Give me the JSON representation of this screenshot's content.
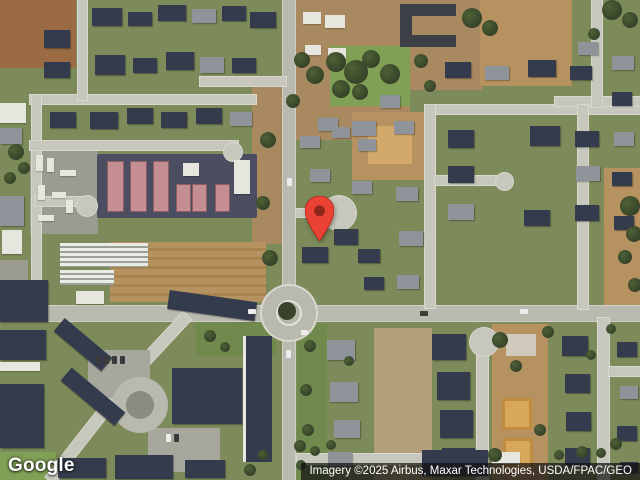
{
  "map": {
    "logo_text": "Google",
    "attribution_text": "Imagery ©2025 Airbus, Maxar Technologies, USDA/FPAC/GEO",
    "marker": {
      "fill": "#EA4335",
      "dot": "#8E2619",
      "tip_x": 319,
      "tip_y": 240
    },
    "features": [
      [
        "dirt2",
        0,
        0,
        76,
        68
      ],
      [
        "dirt3",
        252,
        82,
        34,
        162
      ],
      [
        "dirt3",
        295,
        0,
        115,
        140
      ],
      [
        "dirt3",
        396,
        0,
        86,
        90
      ],
      [
        "dirt",
        480,
        0,
        92,
        86
      ],
      [
        "dirt",
        352,
        112,
        80,
        68
      ],
      [
        "dirt4",
        368,
        126,
        44,
        38
      ],
      [
        "dirt",
        604,
        168,
        36,
        138
      ],
      [
        "field",
        110,
        242,
        156,
        60
      ],
      [
        "dirt5",
        374,
        328,
        58,
        152
      ],
      [
        "dirt",
        492,
        324,
        56,
        156
      ],
      [
        "lawn",
        330,
        46,
        80,
        60
      ],
      [
        "lawn",
        0,
        452,
        56,
        28
      ],
      [
        "lawn2",
        297,
        324,
        30,
        156
      ],
      [
        "lawn2",
        196,
        322,
        80,
        34
      ],
      [
        "yard",
        30,
        146,
        68,
        88
      ],
      [
        "yard",
        0,
        260,
        28,
        42
      ],
      [
        "asphL",
        97,
        154,
        160,
        64
      ],
      [
        "roadm",
        0,
        306,
        640,
        15
      ],
      [
        "roadm",
        283,
        0,
        12,
        480
      ],
      [
        "road",
        30,
        95,
        226,
        9
      ],
      [
        "road",
        78,
        0,
        9,
        100
      ],
      [
        "road",
        32,
        95,
        9,
        215
      ],
      [
        "road",
        30,
        141,
        208,
        9
      ],
      [
        "road",
        35,
        197,
        52,
        9
      ],
      [
        "cul",
        77,
        196,
        20,
        20
      ],
      [
        "cul",
        224,
        143,
        18,
        18
      ],
      [
        "road",
        200,
        77,
        86,
        9
      ],
      [
        "road",
        425,
        105,
        215,
        9
      ],
      [
        "road",
        425,
        105,
        10,
        203
      ],
      [
        "road",
        555,
        97,
        85,
        9
      ],
      [
        "road",
        592,
        0,
        10,
        107
      ],
      [
        "road",
        578,
        105,
        10,
        204
      ],
      [
        "road",
        435,
        176,
        68,
        9
      ],
      [
        "cul",
        496,
        173,
        17,
        17
      ],
      [
        "road",
        296,
        209,
        28,
        8
      ],
      [
        "cul",
        322,
        196,
        34,
        34
      ],
      [
        "road",
        477,
        346,
        11,
        134
      ],
      [
        "cul",
        470,
        328,
        28,
        28
      ],
      [
        "road",
        297,
        454,
        183,
        10
      ],
      [
        "road",
        598,
        318,
        11,
        162
      ],
      [
        "road",
        609,
        367,
        31,
        9
      ],
      [
        "droad",
        103,
        347,
        100,
        11,
        133
      ],
      [
        "droad",
        28,
        430,
        114,
        11,
        128
      ],
      [
        "lot",
        88,
        350,
        62,
        48
      ],
      [
        "lot",
        148,
        428,
        72,
        44
      ],
      [
        "cul2",
        112,
        377,
        56,
        56
      ],
      [
        "culc",
        126,
        391,
        28,
        28
      ],
      [
        "asph",
        400,
        4,
        12,
        43
      ],
      [
        "asph",
        400,
        4,
        56,
        12
      ],
      [
        "asph",
        400,
        35,
        56,
        12
      ],
      [
        "cul3",
        262,
        286,
        54,
        54
      ],
      [
        "isl",
        276,
        300,
        26,
        26
      ],
      [
        "bush",
        278,
        302,
        18,
        18
      ],
      [
        "hp",
        108,
        162,
        15,
        49
      ],
      [
        "hp",
        131,
        162,
        15,
        49
      ],
      [
        "hp",
        154,
        162,
        14,
        49
      ],
      [
        "hp",
        177,
        185,
        13,
        26
      ],
      [
        "hp",
        193,
        185,
        13,
        26
      ],
      [
        "hp",
        216,
        185,
        13,
        26
      ],
      [
        "hw",
        183,
        163,
        16,
        13
      ],
      [
        "hw",
        234,
        160,
        16,
        34
      ],
      [
        "gh",
        60,
        243,
        88,
        24
      ],
      [
        "gh",
        60,
        270,
        54,
        15
      ],
      [
        "hw",
        76,
        291,
        28,
        13
      ],
      [
        "hw",
        0,
        103,
        26,
        20
      ],
      [
        "hg",
        0,
        128,
        22,
        16
      ],
      [
        "hg",
        0,
        196,
        24,
        30
      ],
      [
        "hw",
        2,
        230,
        20,
        24
      ],
      [
        "hw",
        36,
        155,
        7,
        16
      ],
      [
        "hw",
        47,
        158,
        7,
        14
      ],
      [
        "hw",
        60,
        170,
        16,
        6
      ],
      [
        "hw",
        38,
        185,
        7,
        15
      ],
      [
        "hw",
        52,
        192,
        14,
        6
      ],
      [
        "hw",
        66,
        200,
        7,
        13
      ],
      [
        "hw",
        38,
        215,
        16,
        6
      ],
      [
        "hn",
        92,
        8,
        30,
        18
      ],
      [
        "hn",
        128,
        12,
        24,
        14
      ],
      [
        "hn",
        158,
        5,
        28,
        16
      ],
      [
        "hg",
        192,
        9,
        24,
        14
      ],
      [
        "hn",
        222,
        6,
        24,
        15
      ],
      [
        "hn",
        250,
        12,
        26,
        16
      ],
      [
        "hn",
        44,
        30,
        26,
        18
      ],
      [
        "hn",
        44,
        62,
        26,
        16
      ],
      [
        "hn",
        95,
        55,
        30,
        20
      ],
      [
        "hn",
        133,
        58,
        24,
        15
      ],
      [
        "hn",
        166,
        52,
        28,
        18
      ],
      [
        "hg",
        200,
        57,
        24,
        16
      ],
      [
        "hn",
        232,
        58,
        24,
        15
      ],
      [
        "hn",
        50,
        112,
        26,
        16
      ],
      [
        "hn",
        90,
        112,
        28,
        17
      ],
      [
        "hn",
        127,
        108,
        26,
        16
      ],
      [
        "hn",
        161,
        112,
        26,
        16
      ],
      [
        "hn",
        196,
        108,
        26,
        16
      ],
      [
        "hg",
        230,
        112,
        22,
        14
      ],
      [
        "hw",
        303,
        12,
        18,
        12
      ],
      [
        "hw",
        325,
        15,
        20,
        13
      ],
      [
        "hw",
        305,
        45,
        16,
        10
      ],
      [
        "hw",
        328,
        48,
        18,
        11
      ],
      [
        "hg",
        318,
        118,
        20,
        13
      ],
      [
        "hg",
        300,
        136,
        20,
        12
      ],
      [
        "hg",
        332,
        127,
        18,
        11
      ],
      [
        "hg",
        358,
        139,
        18,
        12
      ],
      [
        "hg",
        310,
        169,
        20,
        13
      ],
      [
        "hg",
        352,
        181,
        20,
        13
      ],
      [
        "hn",
        334,
        229,
        24,
        16
      ],
      [
        "hn",
        302,
        247,
        26,
        16
      ],
      [
        "hn",
        358,
        249,
        22,
        14
      ],
      [
        "hg",
        396,
        187,
        22,
        14
      ],
      [
        "hg",
        399,
        231,
        24,
        15
      ],
      [
        "hg",
        397,
        275,
        22,
        14
      ],
      [
        "hn",
        364,
        277,
        20,
        13
      ],
      [
        "hg",
        380,
        95,
        20,
        13
      ],
      [
        "hg",
        352,
        121,
        24,
        15
      ],
      [
        "hg",
        394,
        121,
        20,
        13
      ],
      [
        "hn",
        445,
        62,
        26,
        16
      ],
      [
        "hg",
        485,
        66,
        24,
        14
      ],
      [
        "hn",
        528,
        60,
        28,
        17
      ],
      [
        "hn",
        570,
        66,
        22,
        14
      ],
      [
        "hg",
        612,
        56,
        22,
        14
      ],
      [
        "hg",
        578,
        42,
        20,
        13
      ],
      [
        "hn",
        448,
        130,
        26,
        18
      ],
      [
        "hn",
        448,
        166,
        26,
        17
      ],
      [
        "hg",
        448,
        204,
        26,
        16
      ],
      [
        "hn",
        530,
        126,
        30,
        20
      ],
      [
        "hn",
        524,
        210,
        26,
        16
      ],
      [
        "hn",
        575,
        131,
        24,
        16
      ],
      [
        "hg",
        576,
        166,
        24,
        15
      ],
      [
        "hn",
        575,
        205,
        24,
        16
      ],
      [
        "hn",
        612,
        92,
        20,
        14
      ],
      [
        "hg",
        614,
        132,
        20,
        14
      ],
      [
        "hn",
        612,
        172,
        20,
        14
      ],
      [
        "hn",
        614,
        216,
        20,
        14
      ],
      [
        "hn",
        0,
        280,
        48,
        42
      ],
      [
        "hn",
        0,
        330,
        46,
        30
      ],
      [
        "hw",
        0,
        362,
        40,
        9
      ],
      [
        "hn",
        0,
        384,
        44,
        64
      ],
      [
        "hn",
        52,
        336,
        62,
        17,
        40
      ],
      [
        "hn",
        58,
        388,
        70,
        17,
        40
      ],
      [
        "hn",
        168,
        296,
        88,
        19,
        8
      ],
      [
        "hn",
        172,
        368,
        70,
        56
      ],
      [
        "apt",
        243,
        336,
        29,
        126
      ],
      [
        "hn",
        58,
        458,
        48,
        20
      ],
      [
        "hn",
        115,
        455,
        58,
        24
      ],
      [
        "hn",
        185,
        460,
        40,
        18
      ],
      [
        "hg",
        327,
        340,
        28,
        20
      ],
      [
        "hg",
        330,
        382,
        28,
        20
      ],
      [
        "hg",
        334,
        420,
        26,
        18
      ],
      [
        "hg",
        328,
        452,
        24,
        14
      ],
      [
        "hn",
        432,
        334,
        34,
        26
      ],
      [
        "hn",
        437,
        372,
        33,
        28
      ],
      [
        "hn",
        440,
        410,
        33,
        28
      ],
      [
        "hn",
        442,
        448,
        33,
        26
      ],
      [
        "hc",
        506,
        334,
        30,
        22
      ],
      [
        "ho",
        502,
        398,
        30,
        32
      ],
      [
        "ho",
        503,
        438,
        30,
        32
      ],
      [
        "hn",
        562,
        336,
        26,
        20
      ],
      [
        "hn",
        565,
        374,
        25,
        19
      ],
      [
        "hn",
        566,
        412,
        25,
        19
      ],
      [
        "hn",
        565,
        448,
        25,
        18
      ],
      [
        "hn",
        617,
        342,
        20,
        15
      ],
      [
        "hg",
        620,
        386,
        18,
        13
      ],
      [
        "hn",
        617,
        426,
        20,
        15
      ],
      [
        "hn",
        620,
        462,
        18,
        11
      ],
      [
        "hn",
        422,
        450,
        66,
        26
      ],
      [
        "hw",
        492,
        452,
        28,
        12
      ],
      [
        "tr",
        326,
        52,
        20,
        20
      ],
      [
        "tr",
        344,
        60,
        24,
        24
      ],
      [
        "tr",
        362,
        50,
        18,
        18
      ],
      [
        "tr",
        380,
        64,
        20,
        20
      ],
      [
        "tr",
        332,
        80,
        18,
        18
      ],
      [
        "tr",
        352,
        84,
        16,
        16
      ],
      [
        "tr",
        462,
        8,
        20,
        20
      ],
      [
        "tr",
        482,
        20,
        16,
        16
      ],
      [
        "tr",
        602,
        0,
        20,
        20
      ],
      [
        "tr",
        622,
        12,
        16,
        16
      ],
      [
        "tr",
        588,
        28,
        12,
        12
      ],
      [
        "tr",
        260,
        132,
        16,
        16
      ],
      [
        "tr",
        256,
        196,
        14,
        14
      ],
      [
        "tr",
        262,
        250,
        16,
        16
      ],
      [
        "tr",
        294,
        52,
        16,
        16
      ],
      [
        "tr",
        306,
        66,
        18,
        18
      ],
      [
        "tr",
        286,
        94,
        14,
        14
      ],
      [
        "tr",
        414,
        54,
        14,
        14
      ],
      [
        "tr",
        424,
        80,
        12,
        12
      ],
      [
        "tr",
        620,
        196,
        20,
        20
      ],
      [
        "tr",
        626,
        226,
        16,
        16
      ],
      [
        "tr",
        618,
        250,
        14,
        14
      ],
      [
        "tr",
        628,
        278,
        14,
        14
      ],
      [
        "tr",
        492,
        332,
        16,
        16
      ],
      [
        "tr",
        510,
        360,
        12,
        12
      ],
      [
        "tr",
        488,
        448,
        14,
        14
      ],
      [
        "tr",
        534,
        424,
        12,
        12
      ],
      [
        "tr",
        542,
        326,
        12,
        12
      ],
      [
        "tr",
        344,
        356,
        10,
        10
      ],
      [
        "tr",
        304,
        340,
        12,
        12
      ],
      [
        "tr",
        300,
        384,
        12,
        12
      ],
      [
        "tr",
        302,
        424,
        12,
        12
      ],
      [
        "tr",
        296,
        460,
        10,
        10
      ],
      [
        "tr",
        606,
        324,
        10,
        10
      ],
      [
        "tr",
        586,
        350,
        10,
        10
      ],
      [
        "tr",
        610,
        438,
        12,
        12
      ],
      [
        "tr",
        244,
        464,
        12,
        12
      ],
      [
        "tr",
        258,
        450,
        10,
        10
      ],
      [
        "tr",
        294,
        440,
        12,
        12
      ],
      [
        "tr",
        310,
        446,
        10,
        10
      ],
      [
        "tr",
        326,
        440,
        10,
        10
      ],
      [
        "tr",
        554,
        450,
        10,
        10
      ],
      [
        "tr",
        576,
        446,
        12,
        12
      ],
      [
        "tr",
        596,
        448,
        10,
        10
      ],
      [
        "tr",
        8,
        144,
        16,
        16
      ],
      [
        "tr",
        18,
        162,
        12,
        12
      ],
      [
        "tr",
        4,
        172,
        12,
        12
      ],
      [
        "tr",
        204,
        330,
        12,
        12
      ],
      [
        "tr",
        220,
        342,
        10,
        10
      ],
      [
        "cw",
        248,
        309,
        8,
        5
      ],
      [
        "cd",
        420,
        311,
        8,
        5
      ],
      [
        "cw",
        520,
        309,
        8,
        5
      ],
      [
        "cw",
        286,
        350,
        5,
        8
      ],
      [
        "cw",
        287,
        178,
        5,
        8
      ],
      [
        "cw",
        301,
        330,
        7,
        5
      ],
      [
        "cd",
        96,
        356,
        5,
        8
      ],
      [
        "cd",
        104,
        356,
        5,
        8
      ],
      [
        "cd",
        112,
        356,
        5,
        8
      ],
      [
        "cd",
        120,
        356,
        5,
        8
      ],
      [
        "cw",
        166,
        434,
        5,
        8
      ],
      [
        "cd",
        174,
        434,
        5,
        8
      ]
    ]
  }
}
